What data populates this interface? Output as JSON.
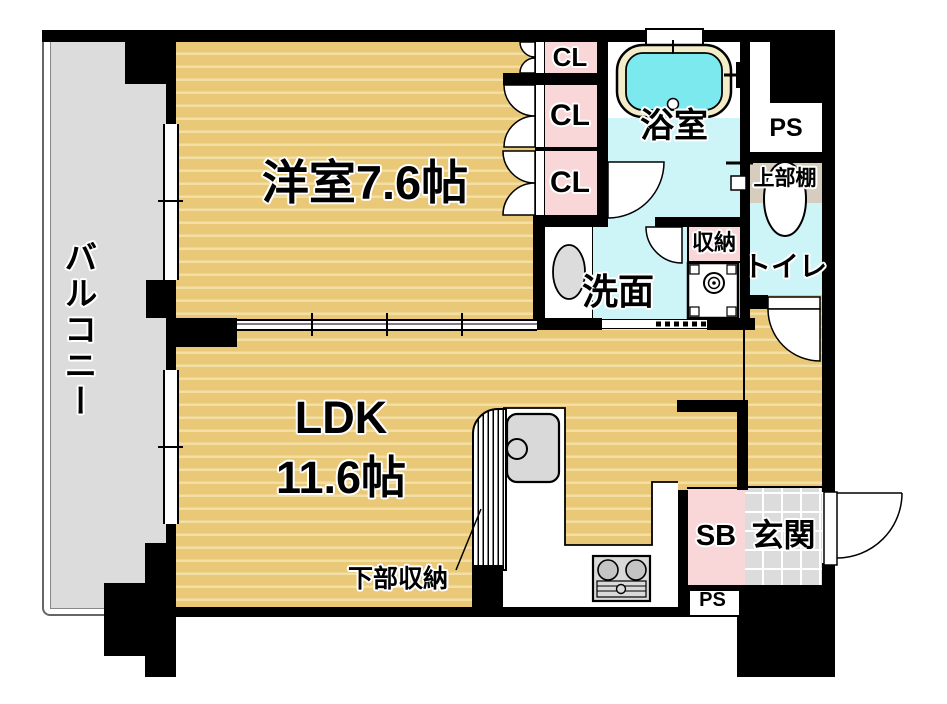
{
  "floorplan": {
    "labels": {
      "balcony": "バルコニー",
      "western_room": "洋室7.6帖",
      "ldk_line1": "LDK",
      "ldk_line2": "11.6帖",
      "cl1": "CL",
      "cl2": "CL",
      "cl3": "CL",
      "bath": "浴室",
      "ps_top": "PS",
      "upper_shelf": "上部棚",
      "toilet": "トイレ",
      "storage": "収納",
      "washroom": "洗面",
      "lower_storage": "下部収納",
      "sb": "SB",
      "entrance": "玄関",
      "ps_bottom": "PS"
    },
    "colors": {
      "wall_black": "#000000",
      "floor_tan": "#E9C878",
      "floor_tan_stripe": "#F3DFA3",
      "closet_pink": "#F9D7D9",
      "wet_area_cyan": "#CDF4F7",
      "tub_water_cyan": "#7CE9EF",
      "tub_rim_cream": "#F2ECC9",
      "balcony_gray": "#DCDCDC",
      "entrance_tile_gray": "#DCDCDC",
      "upper_shelf_beige": "#D6CDBF"
    }
  }
}
